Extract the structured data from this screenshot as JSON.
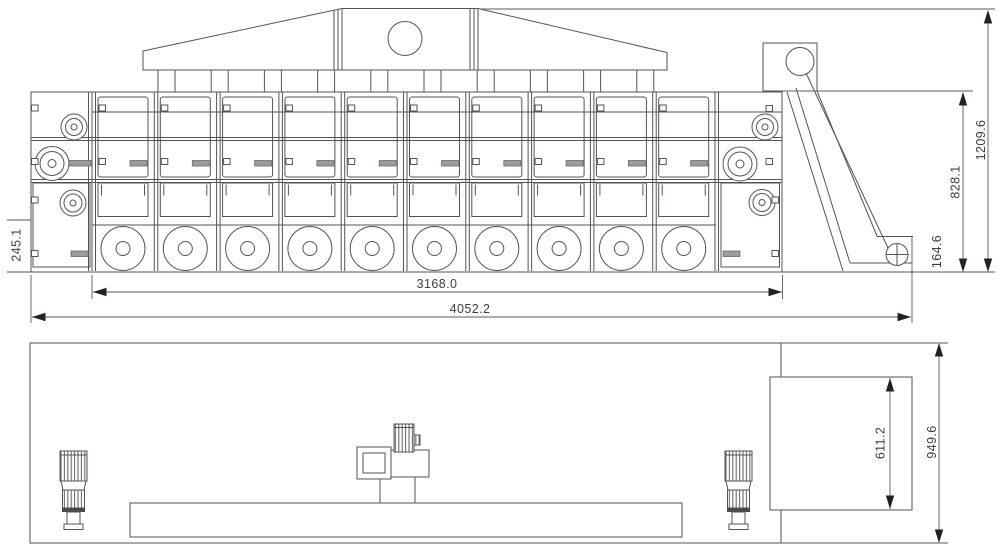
{
  "drawing": {
    "colors": {
      "line": "#575352",
      "arrow": "#262120",
      "text": "#413d3b",
      "handle_gray": "#9d9b9b",
      "background": "#ffffff"
    }
  },
  "side_view": {
    "module_count": 10,
    "duct_count": 10,
    "fan_per_module": 1,
    "dims": {
      "overall_length": "4052.2",
      "working_length": "3168.0",
      "total_height": "1209.6",
      "body_height": "828.1",
      "outlet_height": "164.6",
      "base_height": "245.1"
    }
  },
  "plan_view": {
    "dims": {
      "outlet_width": "611.2",
      "overall_width": "949.6"
    }
  }
}
